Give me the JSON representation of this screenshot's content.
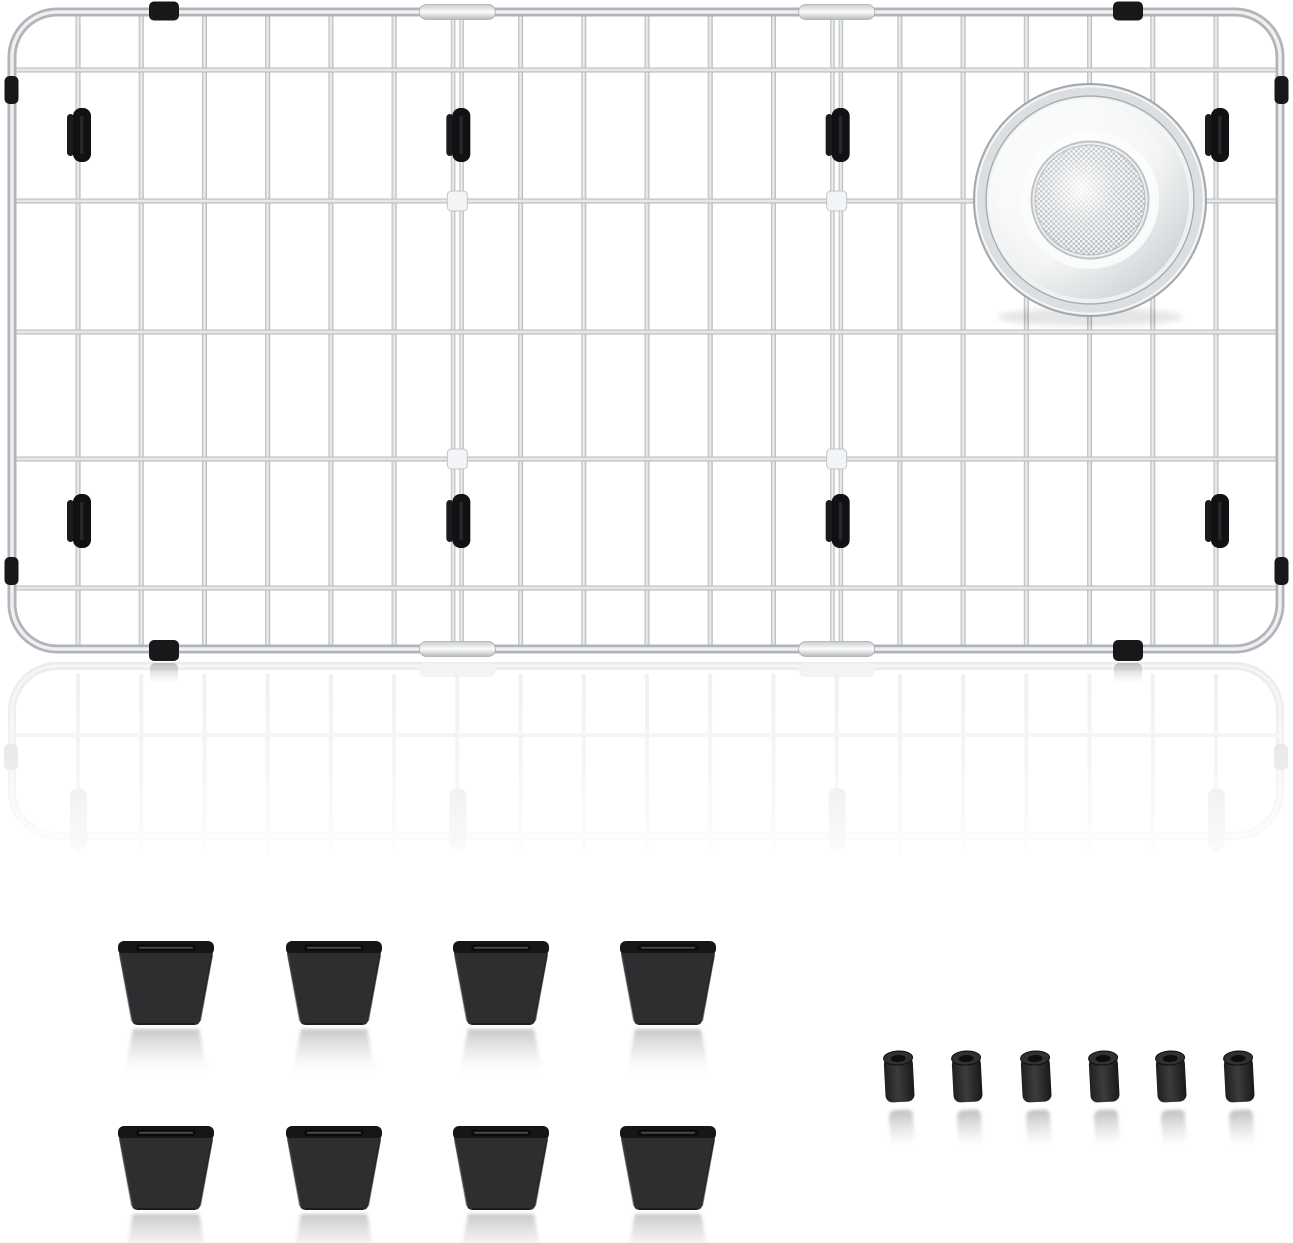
{
  "image": {
    "background": "#ffffff",
    "description": "Stainless steel kitchen sink bottom grid with round drain strainer opening at top right, black protective clips, eight black rubber feet and six black rubber spacers on a white studio background"
  },
  "sink_grid": {
    "columns": 20,
    "rows": 6,
    "wire_color": "#b4b7ba",
    "wire_highlight": "#f3f4f5",
    "frame_color": "#b1b4b8",
    "frame_highlight": "#eef0f1",
    "support_wires": 2,
    "junction_blocks": 4,
    "black_clamps": 4,
    "black_side_clips": 4,
    "black_wire_feet": 8,
    "accessory_color": "#17181a"
  },
  "drain_strainer": {
    "position": "top-right",
    "body_color": "#f4f5f6",
    "rim_color": "#dcdfe1",
    "mesh_color": "#b6bbbf",
    "edge_color": "#a3a7ab"
  },
  "rubber_feet": {
    "count": 8,
    "rows": 2,
    "per_row": 4,
    "body_color": "#2d2e30",
    "top_color": "#151617",
    "slot_color": "#0a0b0b"
  },
  "rubber_spacers": {
    "count": 6,
    "body_color": "#2b2c2e",
    "hole_color": "#0c0d0e"
  }
}
